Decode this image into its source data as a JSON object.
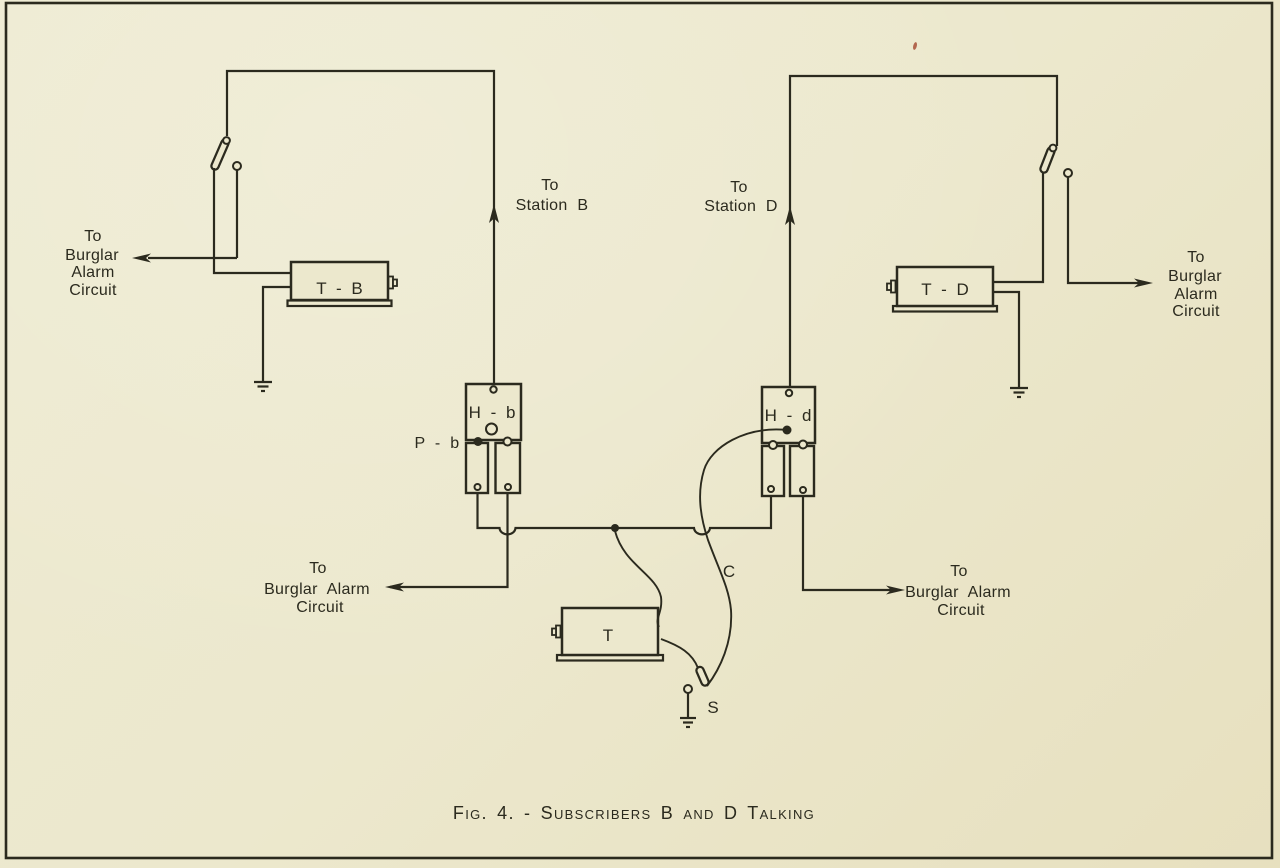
{
  "colors": {
    "paper": "#ece8cd",
    "ink": "#2b2a1e"
  },
  "figure": {
    "caption": "Fig. 4. - Subscribers B and D Talking"
  },
  "station_b": {
    "to_station": [
      "To",
      "Station B"
    ],
    "switch_burglar_alarm": [
      "To",
      "Burglar",
      "Alarm",
      "Circuit"
    ],
    "transmitter": "T - B",
    "hook_jack": "H - b",
    "plug": "P - b",
    "jack_burglar_alarm": [
      "To",
      "Burglar Alarm",
      "Circuit"
    ]
  },
  "station_d": {
    "to_station": [
      "To",
      "Station D"
    ],
    "switch_burglar_alarm": [
      "To",
      "Burglar",
      "Alarm",
      "Circuit"
    ],
    "transmitter": "T - D",
    "hook_jack": "H - d",
    "jack_burglar_alarm": [
      "To",
      "Burglar Alarm",
      "Circuit"
    ]
  },
  "operator": {
    "transmitter": "T",
    "cord": "C",
    "plug": "S"
  }
}
